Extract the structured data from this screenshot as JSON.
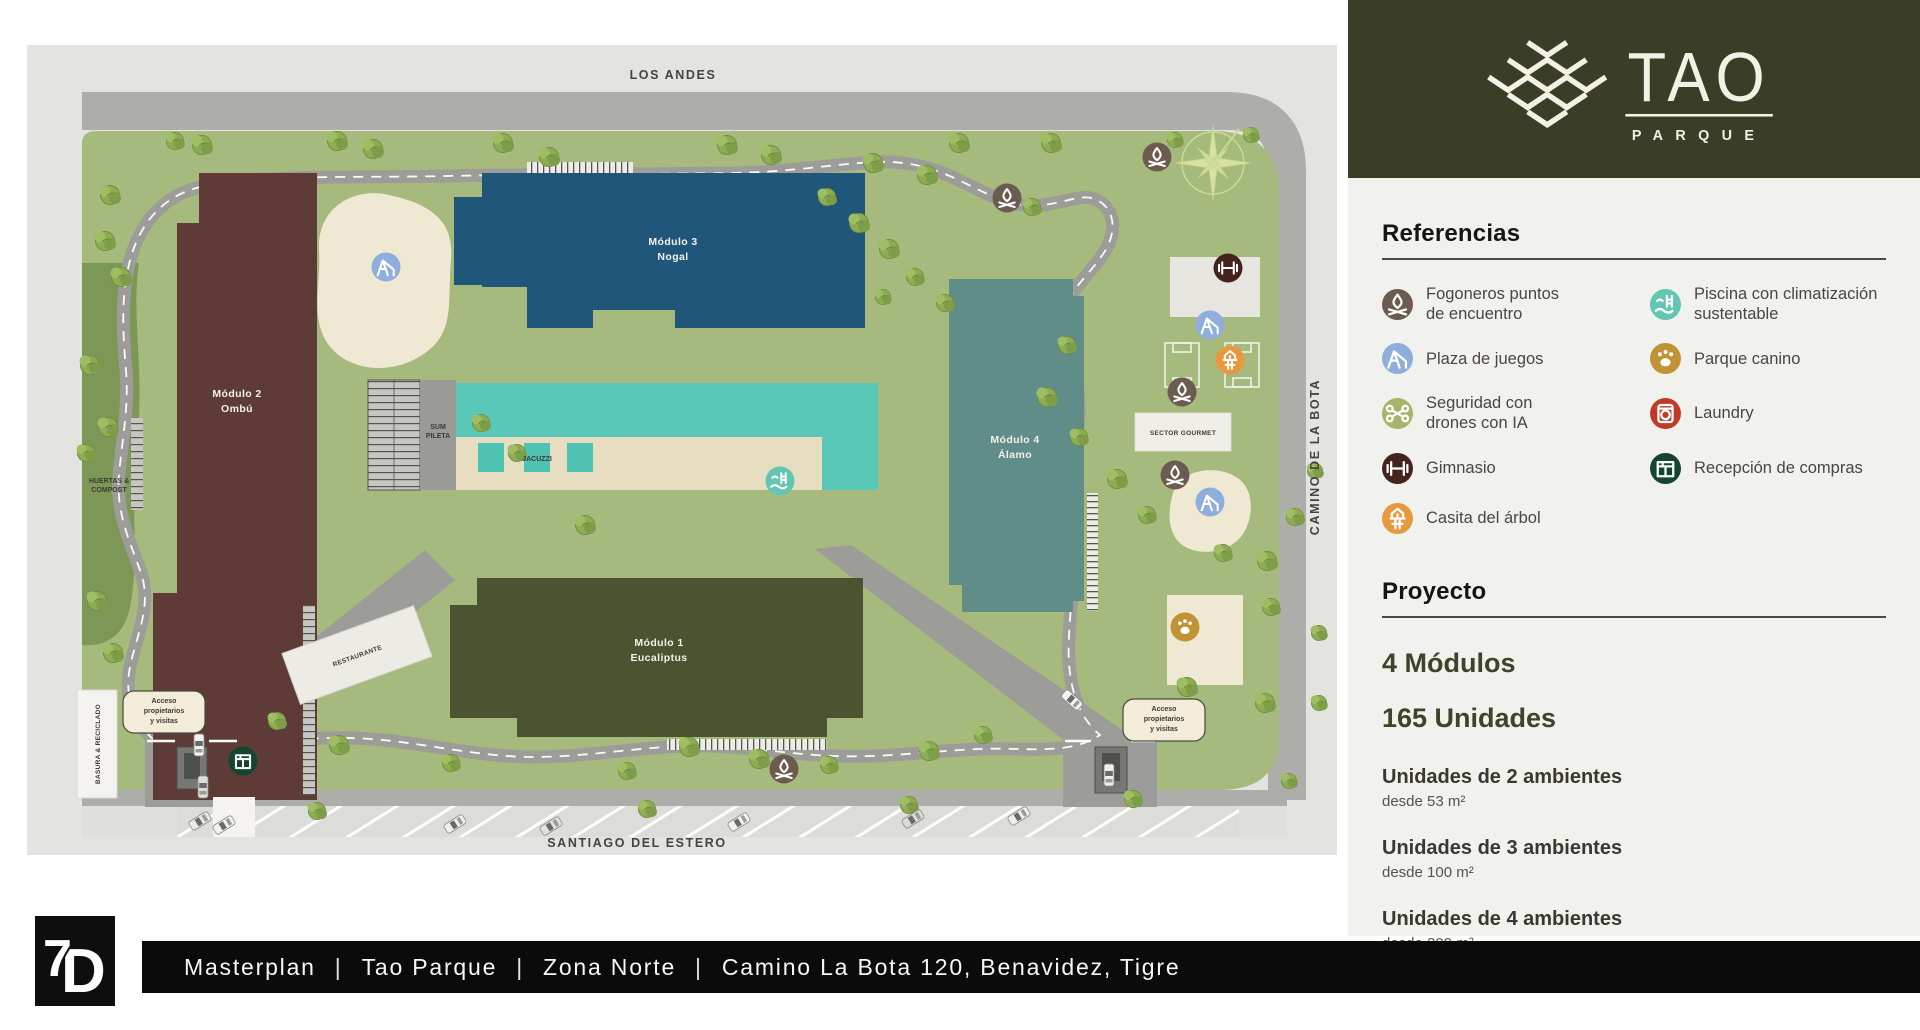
{
  "header": {
    "logo_title": "TAO",
    "logo_subtitle": "PARQUE"
  },
  "sidebar": {
    "referencias_title": "Referencias",
    "legend": [
      {
        "icon": "campfire",
        "color": "#6B5B50",
        "label": "Fogoneros puntos\nde encuentro"
      },
      {
        "icon": "pool",
        "color": "#62C6B1",
        "label": "Piscina con climatización\nsustentable"
      },
      {
        "icon": "playground",
        "color": "#8FAEDC",
        "label": "Plaza de juegos"
      },
      {
        "icon": "paw",
        "color": "#C09335",
        "label": "Parque canino"
      },
      {
        "icon": "drone",
        "color": "#A7B469",
        "label": "Seguridad con\ndrones con IA"
      },
      {
        "icon": "laundry",
        "color": "#C13A28",
        "label": "Laundry"
      },
      {
        "icon": "gym",
        "color": "#45231D",
        "label": "Gimnasio"
      },
      {
        "icon": "package",
        "color": "#14452F",
        "label": "Recepción de compras"
      },
      {
        "icon": "treehouse",
        "color": "#E8993F",
        "label": "Casita del árbol"
      }
    ],
    "proyecto_title": "Proyecto",
    "stat_modulos": "4 Módulos",
    "stat_unidades": "165 Unidades",
    "units": [
      {
        "title": "Unidades de 2 ambientes",
        "subtitle": "desde 53 m²"
      },
      {
        "title": "Unidades de 3 ambientes",
        "subtitle": "desde 100 m²"
      },
      {
        "title": "Unidades de 4 ambientes",
        "subtitle": "desde 209 m²"
      }
    ]
  },
  "map": {
    "street_top": "LOS ANDES",
    "street_bottom": "SANTIAGO DEL ESTERO",
    "street_right": "CAMINO DE LA BOTA",
    "huertas_l1": "HUERTAS &",
    "huertas_l2": "COMPOST",
    "basura": "BASURA & RECICLADO",
    "acceso_l1": "Acceso",
    "acceso_l2": "propietarios",
    "acceso_l3": "y visitas",
    "sum_l1": "SUM",
    "sum_l2": "PILETA",
    "jacuzzi": "JACUZZI",
    "restaurante": "RESTAURANTE",
    "sector_gourmet": "SECTOR GOURMET",
    "modules": [
      {
        "name": "Módulo 1",
        "tree": "Eucaliptus",
        "color": "#4A5430"
      },
      {
        "name": "Módulo 2",
        "tree": "Ombú",
        "color": "#5E3B36"
      },
      {
        "name": "Módulo 3",
        "tree": "Nogal",
        "color": "#20567A"
      },
      {
        "name": "Módulo 4",
        "tree": "Álamo",
        "color": "#618D89"
      }
    ],
    "icons": [
      {
        "icon": "campfire",
        "x": 1130,
        "y": 112
      },
      {
        "icon": "campfire",
        "x": 980,
        "y": 153
      },
      {
        "icon": "playground",
        "x": 359,
        "y": 222
      },
      {
        "icon": "gym",
        "x": 1201,
        "y": 223
      },
      {
        "icon": "playground",
        "x": 1183,
        "y": 280
      },
      {
        "icon": "treehouse",
        "x": 1203,
        "y": 315
      },
      {
        "icon": "campfire",
        "x": 1155,
        "y": 347
      },
      {
        "icon": "campfire",
        "x": 1148,
        "y": 430
      },
      {
        "icon": "playground",
        "x": 1183,
        "y": 457
      },
      {
        "icon": "paw",
        "x": 1158,
        "y": 582
      },
      {
        "icon": "pool",
        "x": 753,
        "y": 436
      },
      {
        "icon": "campfire",
        "x": 757,
        "y": 724
      },
      {
        "icon": "package",
        "x": 216,
        "y": 716
      }
    ],
    "trees": [
      [
        175,
        100
      ],
      [
        310,
        96
      ],
      [
        346,
        104
      ],
      [
        476,
        98
      ],
      [
        522,
        112
      ],
      [
        700,
        100
      ],
      [
        744,
        110
      ],
      [
        846,
        118
      ],
      [
        900,
        130
      ],
      [
        932,
        98
      ],
      [
        1024,
        98
      ],
      [
        1148,
        95,
        0.8
      ],
      [
        1224,
        90,
        0.8
      ],
      [
        148,
        96,
        0.9
      ],
      [
        83,
        150
      ],
      [
        78,
        196
      ],
      [
        94,
        232
      ],
      [
        63,
        320
      ],
      [
        81,
        382
      ],
      [
        59,
        408,
        0.9
      ],
      [
        70,
        556
      ],
      [
        86,
        608
      ],
      [
        454,
        378,
        0.9
      ],
      [
        490,
        408,
        0.9
      ],
      [
        558,
        480
      ],
      [
        800,
        152,
        0.9
      ],
      [
        832,
        178
      ],
      [
        862,
        204
      ],
      [
        888,
        232,
        0.9
      ],
      [
        856,
        252,
        0.8
      ],
      [
        918,
        258,
        0.9
      ],
      [
        1005,
        162,
        0.9
      ],
      [
        1040,
        300,
        0.9
      ],
      [
        1020,
        352
      ],
      [
        1052,
        392,
        0.9
      ],
      [
        1090,
        434
      ],
      [
        1120,
        470,
        0.9
      ],
      [
        1196,
        508,
        0.9
      ],
      [
        1240,
        516
      ],
      [
        1268,
        472,
        0.9
      ],
      [
        1288,
        426,
        0.8
      ],
      [
        1244,
        562,
        0.9
      ],
      [
        1292,
        588,
        0.8
      ],
      [
        1160,
        642
      ],
      [
        1238,
        658
      ],
      [
        1292,
        658,
        0.8
      ],
      [
        250,
        676,
        0.9
      ],
      [
        312,
        700
      ],
      [
        424,
        718,
        0.9
      ],
      [
        600,
        726,
        0.9
      ],
      [
        662,
        702
      ],
      [
        732,
        714
      ],
      [
        802,
        720,
        0.9
      ],
      [
        902,
        706
      ],
      [
        956,
        690,
        0.9
      ],
      [
        290,
        766,
        0.9
      ],
      [
        620,
        764,
        0.9
      ],
      [
        882,
        760,
        0.9
      ],
      [
        1106,
        754,
        0.9
      ],
      [
        1262,
        736,
        0.8
      ]
    ],
    "cars": [
      [
        172,
        700,
        90,
        "#F2F2F0"
      ],
      [
        176,
        742,
        90,
        "#DDDDDA"
      ],
      [
        1082,
        730,
        90,
        "#EFEFEC"
      ],
      [
        1045,
        655,
        42,
        "#F5F5F2"
      ],
      [
        173,
        776,
        -32,
        "#E8E8E5"
      ],
      [
        197,
        780,
        -32,
        "#F2F2F0"
      ],
      [
        428,
        779,
        -32,
        "#EFEFEC"
      ],
      [
        524,
        781,
        -32,
        "#E2E2DF"
      ],
      [
        712,
        777,
        -32,
        "#F2F2F0"
      ],
      [
        886,
        774,
        -32,
        "#DADAD7"
      ],
      [
        992,
        771,
        -32,
        "#EFEFEC"
      ]
    ]
  },
  "footer": {
    "items": [
      "Masterplan",
      "Tao Parque",
      "Zona Norte",
      "Camino La Bota 120, Benavidez, Tigre"
    ],
    "separator": "|"
  }
}
